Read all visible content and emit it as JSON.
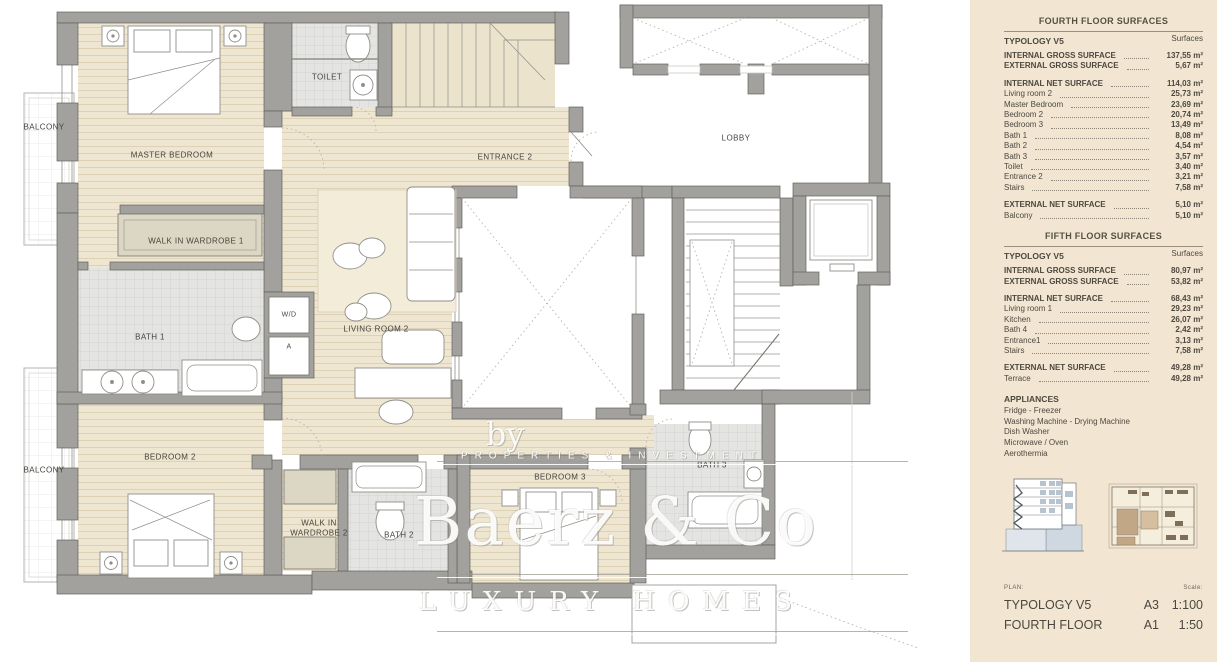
{
  "plan": {
    "rooms": {
      "balcony_top": "BALCONY",
      "master_bedroom": "MASTER BEDROOM",
      "toilet": "TOILET",
      "entrance_2": "ENTRANCE 2",
      "lobby": "LOBBY",
      "walk_in_wardrobe_1": "WALK IN WARDROBE 1",
      "bath_1": "BATH 1",
      "wd": "W/D",
      "a_closet": "A",
      "living_room_2": "LIVING ROOM 2",
      "bedroom_2": "BEDROOM 2",
      "balcony_bottom": "BALCONY",
      "walk_in_wardrobe_2": "WALK IN WARDROBE 2",
      "bath_2": "BATH 2",
      "bedroom_3": "BEDROOM 3",
      "bath_3": "BATH 3"
    },
    "watermark": {
      "by": "by",
      "properties": "PROPERTIES & INVESTMENT",
      "brand": "Baerz & Co",
      "homes": "LUXURY HOMES"
    }
  },
  "sidebar": {
    "fourth": {
      "title": "FOURTH FLOOR SURFACES",
      "col": "Surfaces",
      "typology": "TYPOLOGY V5",
      "groups": [
        {
          "rows": [
            {
              "label": "INTERNAL GROSS SURFACE",
              "value": "137,55 m²"
            },
            {
              "label": "EXTERNAL GROSS SURFACE",
              "value": "5,67 m²"
            }
          ]
        },
        {
          "rows": [
            {
              "label": "INTERNAL NET SURFACE",
              "value": "114,03 m²"
            },
            {
              "label": "Living room 2",
              "value": "25,73 m²"
            },
            {
              "label": "Master Bedroom",
              "value": "23,69 m²"
            },
            {
              "label": "Bedroom 2",
              "value": "20,74 m²"
            },
            {
              "label": "Bedroom 3",
              "value": "13,49 m²"
            },
            {
              "label": "Bath 1",
              "value": "8,08 m²"
            },
            {
              "label": "Bath 2",
              "value": "4,54 m²"
            },
            {
              "label": "Bath 3",
              "value": "3,57 m²"
            },
            {
              "label": "Toilet",
              "value": "3,40 m²"
            },
            {
              "label": "Entrance 2",
              "value": "3,21 m²"
            },
            {
              "label": "Stairs",
              "value": "7,58 m²"
            }
          ]
        },
        {
          "rows": [
            {
              "label": "EXTERNAL NET SURFACE",
              "value": "5,10 m²"
            },
            {
              "label": "Balcony",
              "value": "5,10 m²"
            }
          ]
        }
      ]
    },
    "fifth": {
      "title": "FIFTH FLOOR SURFACES",
      "col": "Surfaces",
      "typology": "TYPOLOGY V5",
      "groups": [
        {
          "rows": [
            {
              "label": "INTERNAL GROSS SURFACE",
              "value": "80,97 m²"
            },
            {
              "label": "EXTERNAL GROSS SURFACE",
              "value": "53,82 m²"
            }
          ]
        },
        {
          "rows": [
            {
              "label": "INTERNAL NET SURFACE",
              "value": "68,43 m²"
            },
            {
              "label": "Living room 1",
              "value": "29,23 m²"
            },
            {
              "label": "Kitchen",
              "value": "26,07 m²"
            },
            {
              "label": "Bath 4",
              "value": "2,42 m²"
            },
            {
              "label": "Entrance1",
              "value": "3,13 m²"
            },
            {
              "label": "Stairs",
              "value": "7,58 m²"
            }
          ]
        },
        {
          "rows": [
            {
              "label": "EXTERNAL NET SURFACE",
              "value": "49,28 m²"
            },
            {
              "label": "Terrace",
              "value": "49,28 m²"
            }
          ]
        }
      ]
    },
    "appliances": {
      "title": "APPLIANCES",
      "items": [
        "Fridge - Freezer",
        "Washing Machine - Drying Machine",
        "Dish Washer",
        "Microwave / Oven",
        "Aerothermia"
      ]
    },
    "footer": {
      "plan_label": "PLAN:",
      "scale_label": "Scale:",
      "rows": [
        {
          "name": "TYPOLOGY V5",
          "sheet": "A3",
          "scale": "1:100"
        },
        {
          "name": "FOURTH FLOOR",
          "sheet": "A1",
          "scale": "1:50"
        }
      ]
    }
  },
  "colors": {
    "sidebar_bg": "#f2e6d3",
    "wall_gray": "#a2a19d",
    "floor_tan": "#efe6d1",
    "tile_gray": "#e4e4e2"
  }
}
